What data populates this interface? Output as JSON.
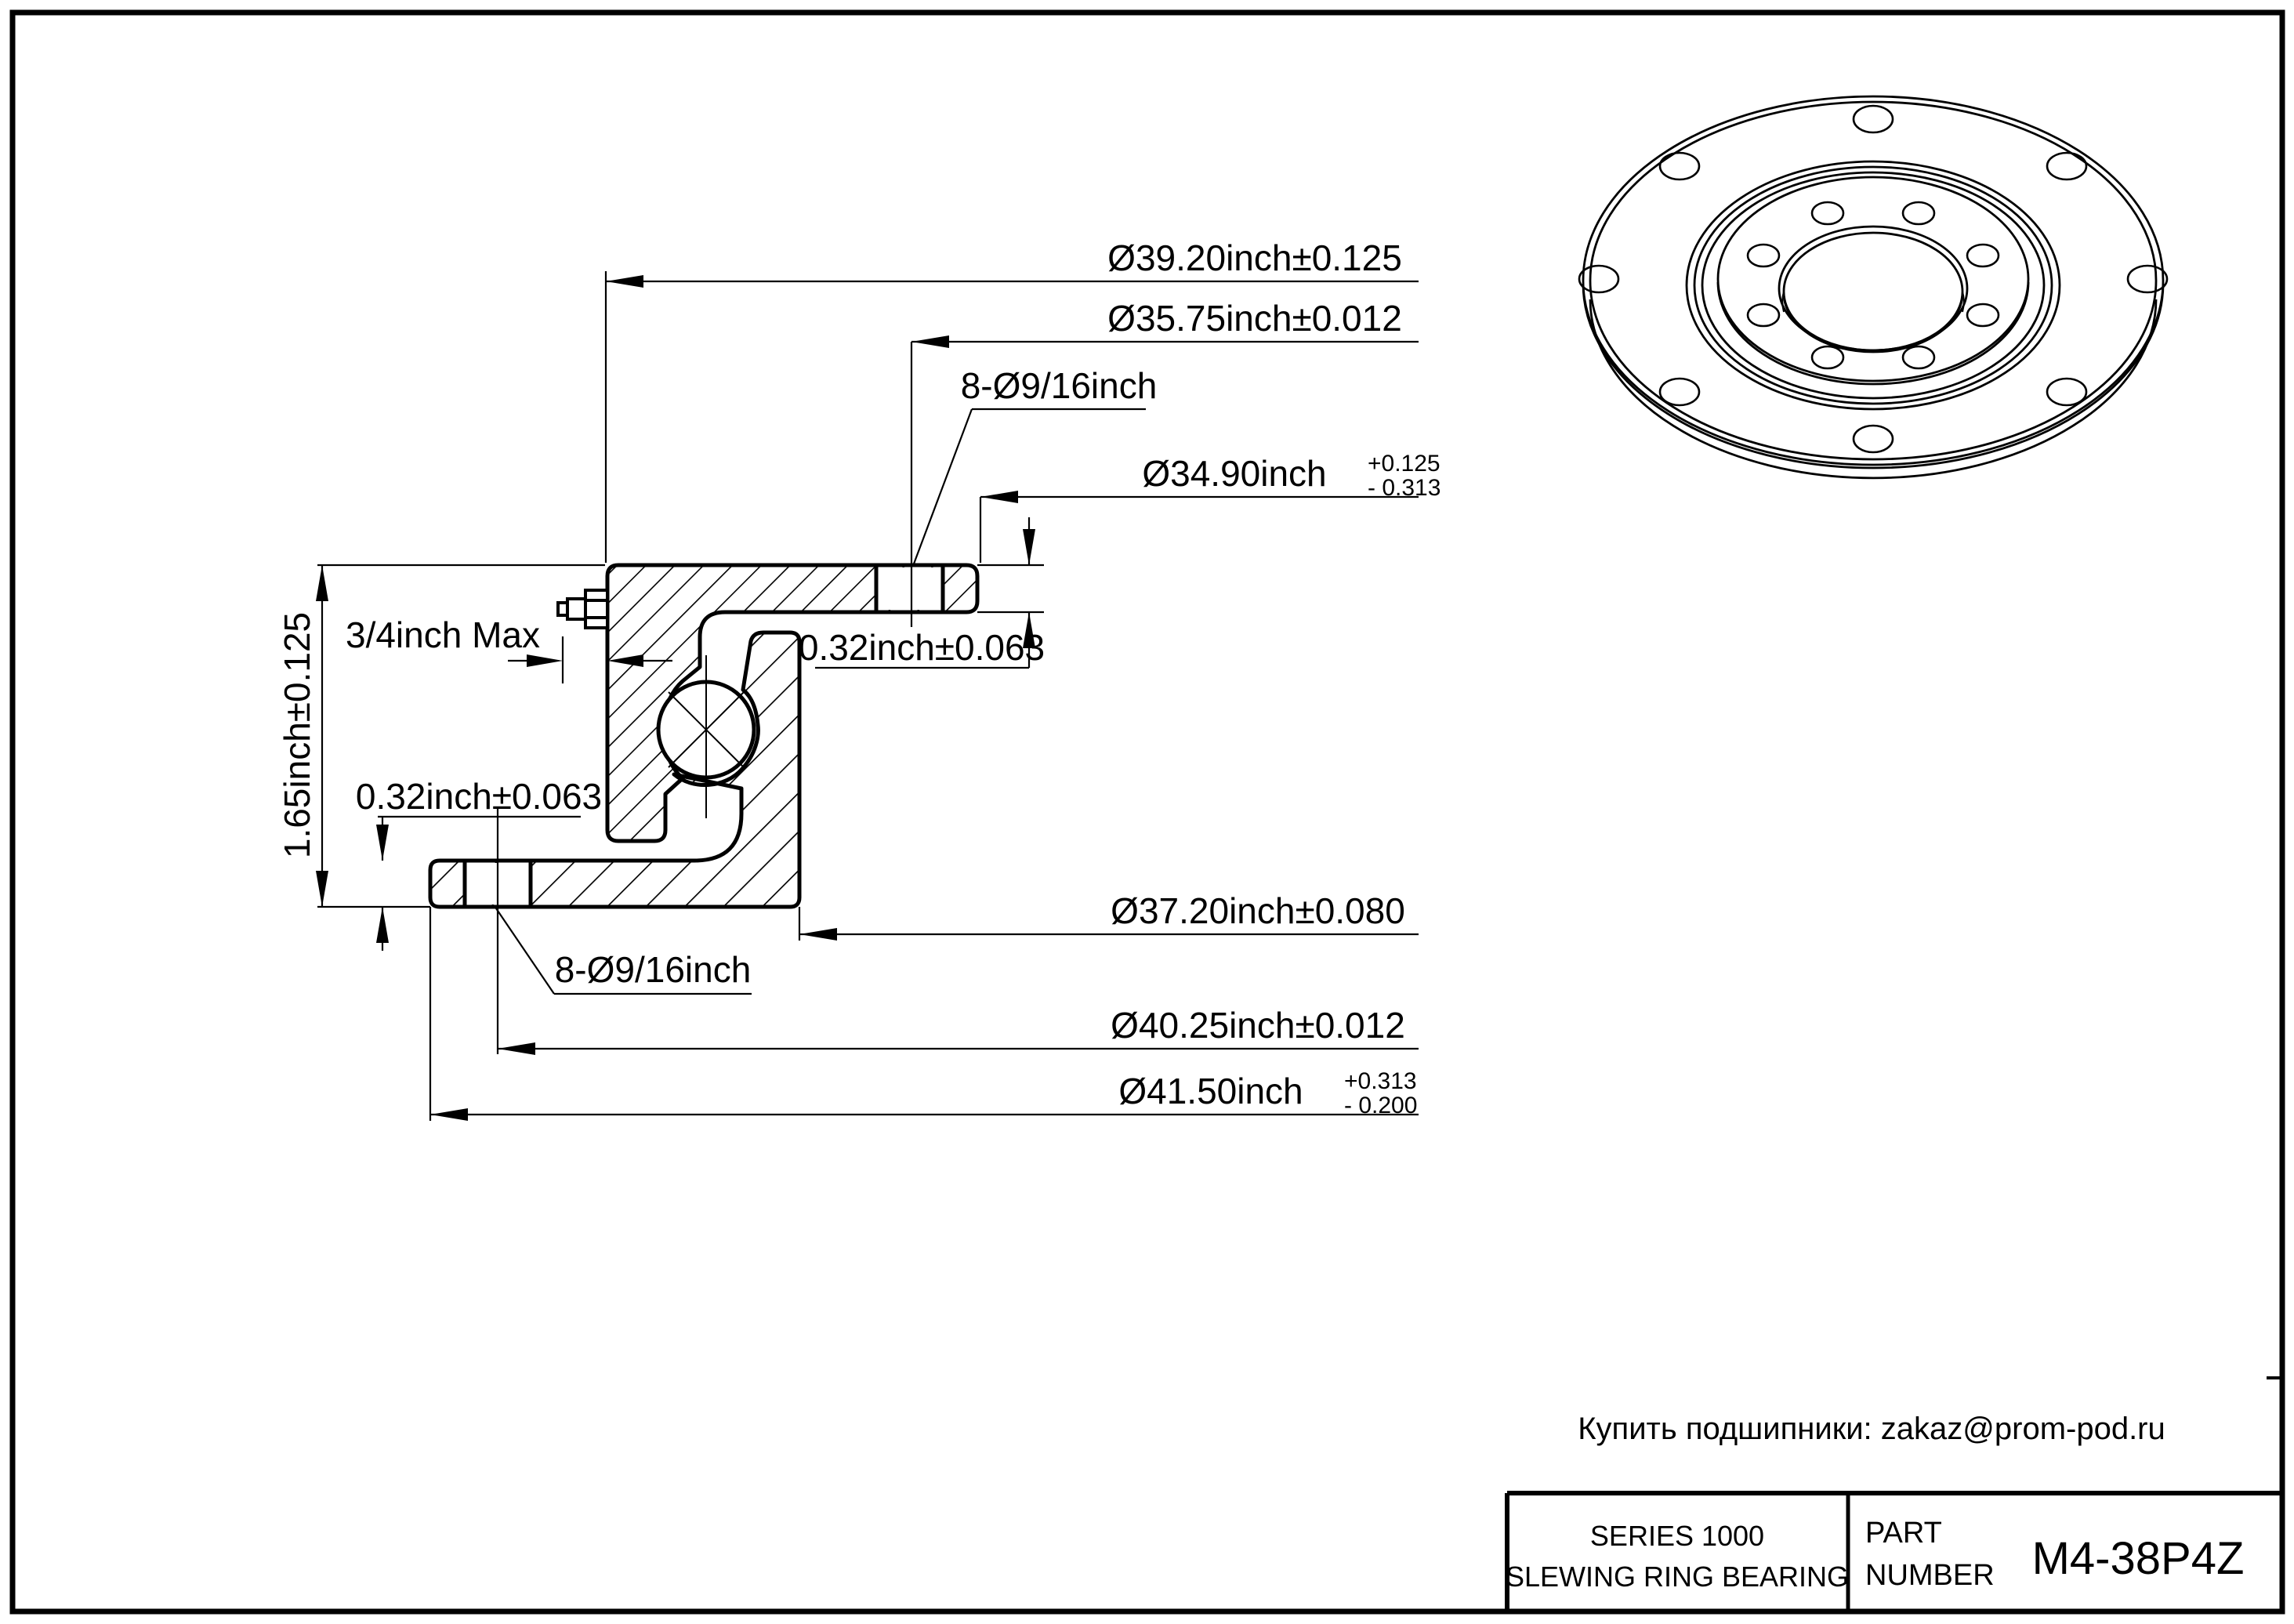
{
  "colors": {
    "ink": "#000000",
    "paper": "#ffffff"
  },
  "drawing": {
    "dims": {
      "d3920": "Ø39.20inch±0.125",
      "d3575": "Ø35.75inch±0.012",
      "bolt_top": "8-Ø9/16inch",
      "d3490": "Ø34.90inch",
      "d3490_plus": "+0.125",
      "d3490_minus": "- 0.313",
      "t032_right": "0.32inch±0.063",
      "grease_max": "3/4inch Max",
      "t032_left": "0.32inch±0.063",
      "height_165": "1.65inch±0.125",
      "bolt_bottom": "8-Ø9/16inch",
      "d3720": "Ø37.20inch±0.080",
      "d4025": "Ø40.25inch±0.012",
      "d4150": "Ø41.50inch",
      "d4150_plus": "+0.313",
      "d4150_minus": "- 0.200"
    }
  },
  "footer": {
    "contact": "Купить подшипники: zakaz@prom-pod.ru"
  },
  "title_block": {
    "series": "SERIES 1000",
    "product": "SLEWING RING BEARING",
    "part_label_line1": "PART",
    "part_label_line2": "NUMBER",
    "part_number": "M4-38P4Z"
  }
}
